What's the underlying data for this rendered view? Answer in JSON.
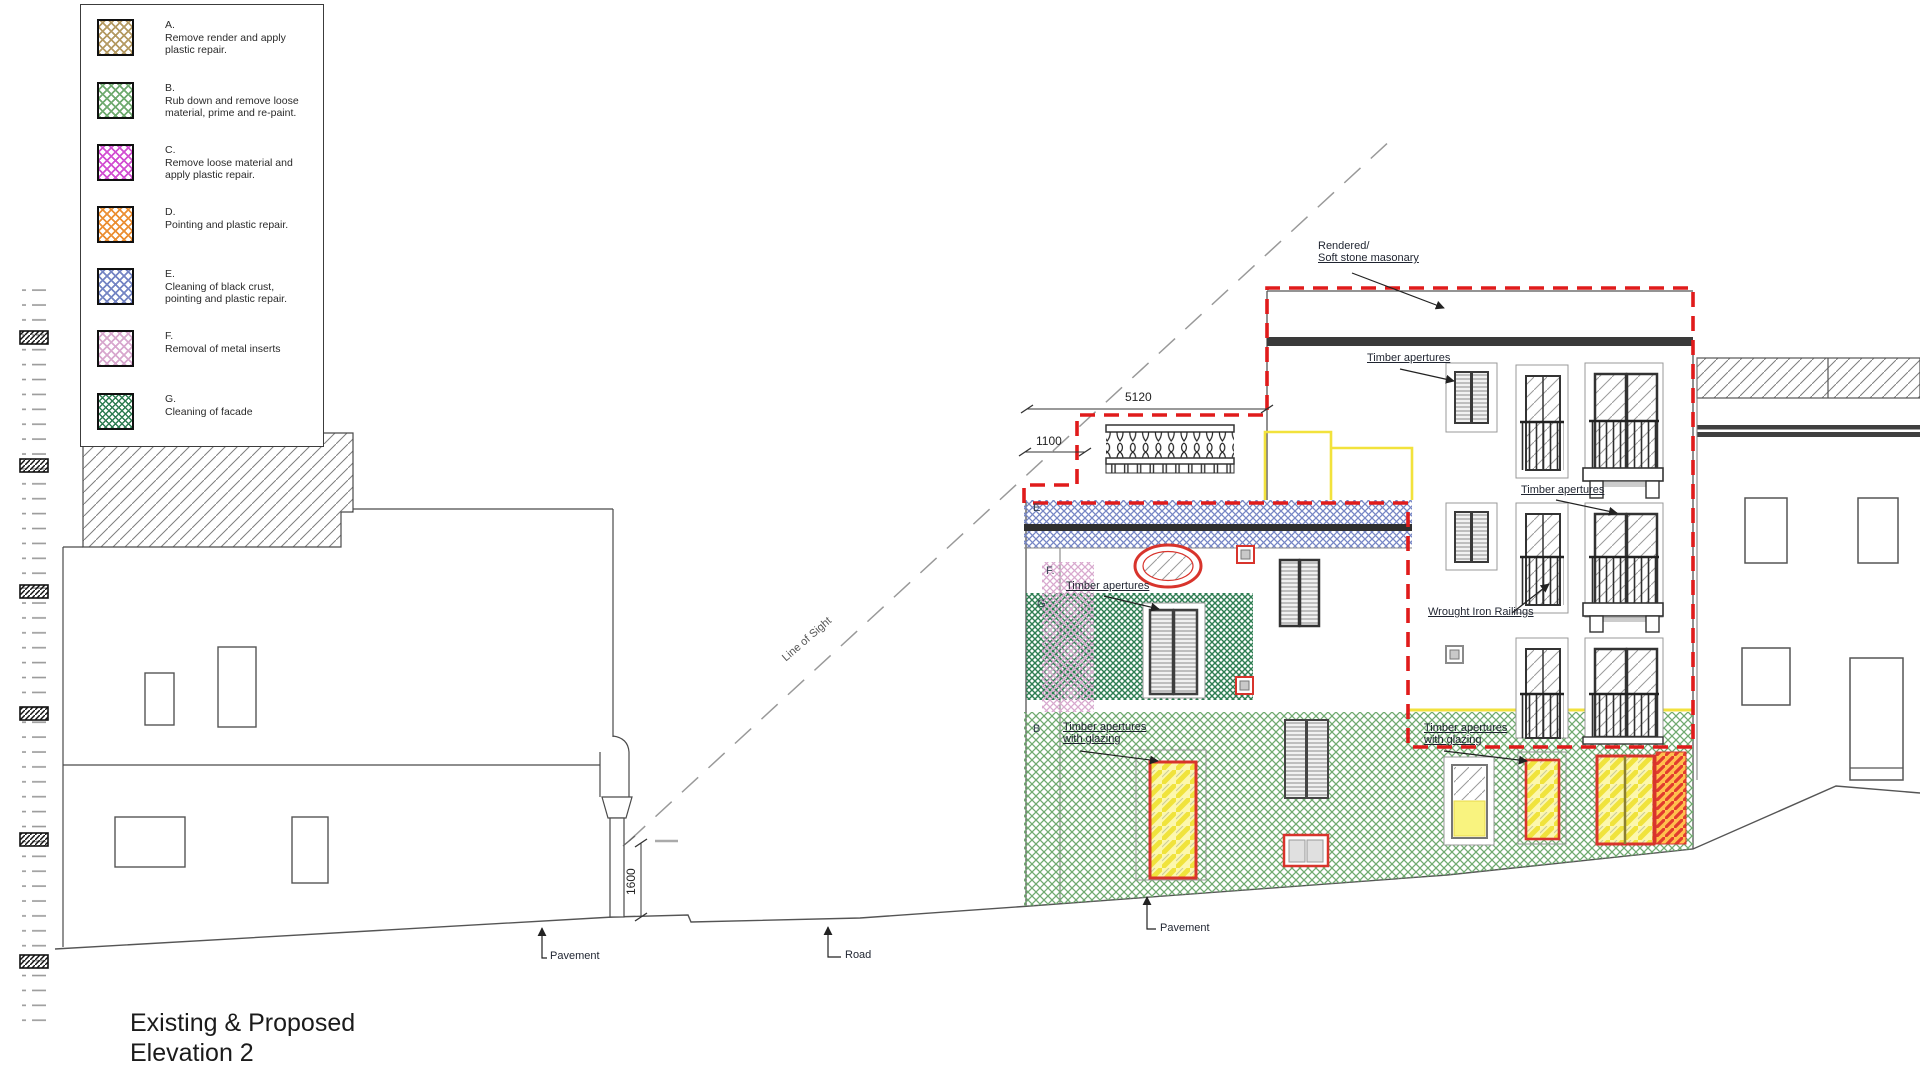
{
  "title": {
    "line1": "Existing & Proposed",
    "line2": "Elevation 2"
  },
  "legend": {
    "items": [
      {
        "letter": "A.",
        "desc1": "Remove render and apply",
        "desc2": "plastic repair."
      },
      {
        "letter": "B.",
        "desc1": "Rub down and remove loose",
        "desc2": "material, prime and re-paint."
      },
      {
        "letter": "C.",
        "desc1": "Remove loose material and",
        "desc2": "apply plastic repair."
      },
      {
        "letter": "D.",
        "desc1": "Pointing and plastic repair.",
        "desc2": ""
      },
      {
        "letter": "E.",
        "desc1": "Cleaning of black crust,",
        "desc2": "pointing and plastic repair."
      },
      {
        "letter": "F.",
        "desc1": "Removal of metal inserts",
        "desc2": ""
      },
      {
        "letter": "G.",
        "desc1": "Cleaning of facade",
        "desc2": ""
      }
    ]
  },
  "labels": {
    "rendered_line1": "Rendered/",
    "rendered_line2": "Soft stone masonary",
    "timber_apertures_top": "Timber apertures",
    "timber_apertures_right": "Timber apertures",
    "timber_apertures_left": "Timber apertures",
    "wrought_iron": "Wrought Iron Railings",
    "timber_glazing_left_line1": "Timber apertures",
    "timber_glazing_left_line2": "with glazing",
    "timber_glazing_right_line1": "Timber apertures",
    "timber_glazing_right_line2": "with glazing",
    "pavement_left": "Pavement",
    "pavement_center": "Pavement",
    "road": "Road",
    "line_of_sight": "Line of Sight",
    "zone_e": "E",
    "zone_f": "F.",
    "zone_g": "G",
    "zone_b": "B"
  },
  "dimensions": {
    "upper_width": "5120",
    "setback": "1100",
    "sight_height": "1600"
  },
  "colors": {
    "red_dashed": "#e01b1b",
    "yellow_outline": "#f2e23c",
    "legend_a": "#b49a62",
    "legend_b": "#6faa6f",
    "legend_c": "#d24fd2",
    "legend_d": "#eb8f33",
    "legend_e": "#7585c4",
    "legend_f": "#d8a8ce",
    "legend_g": "#2e7d52"
  }
}
